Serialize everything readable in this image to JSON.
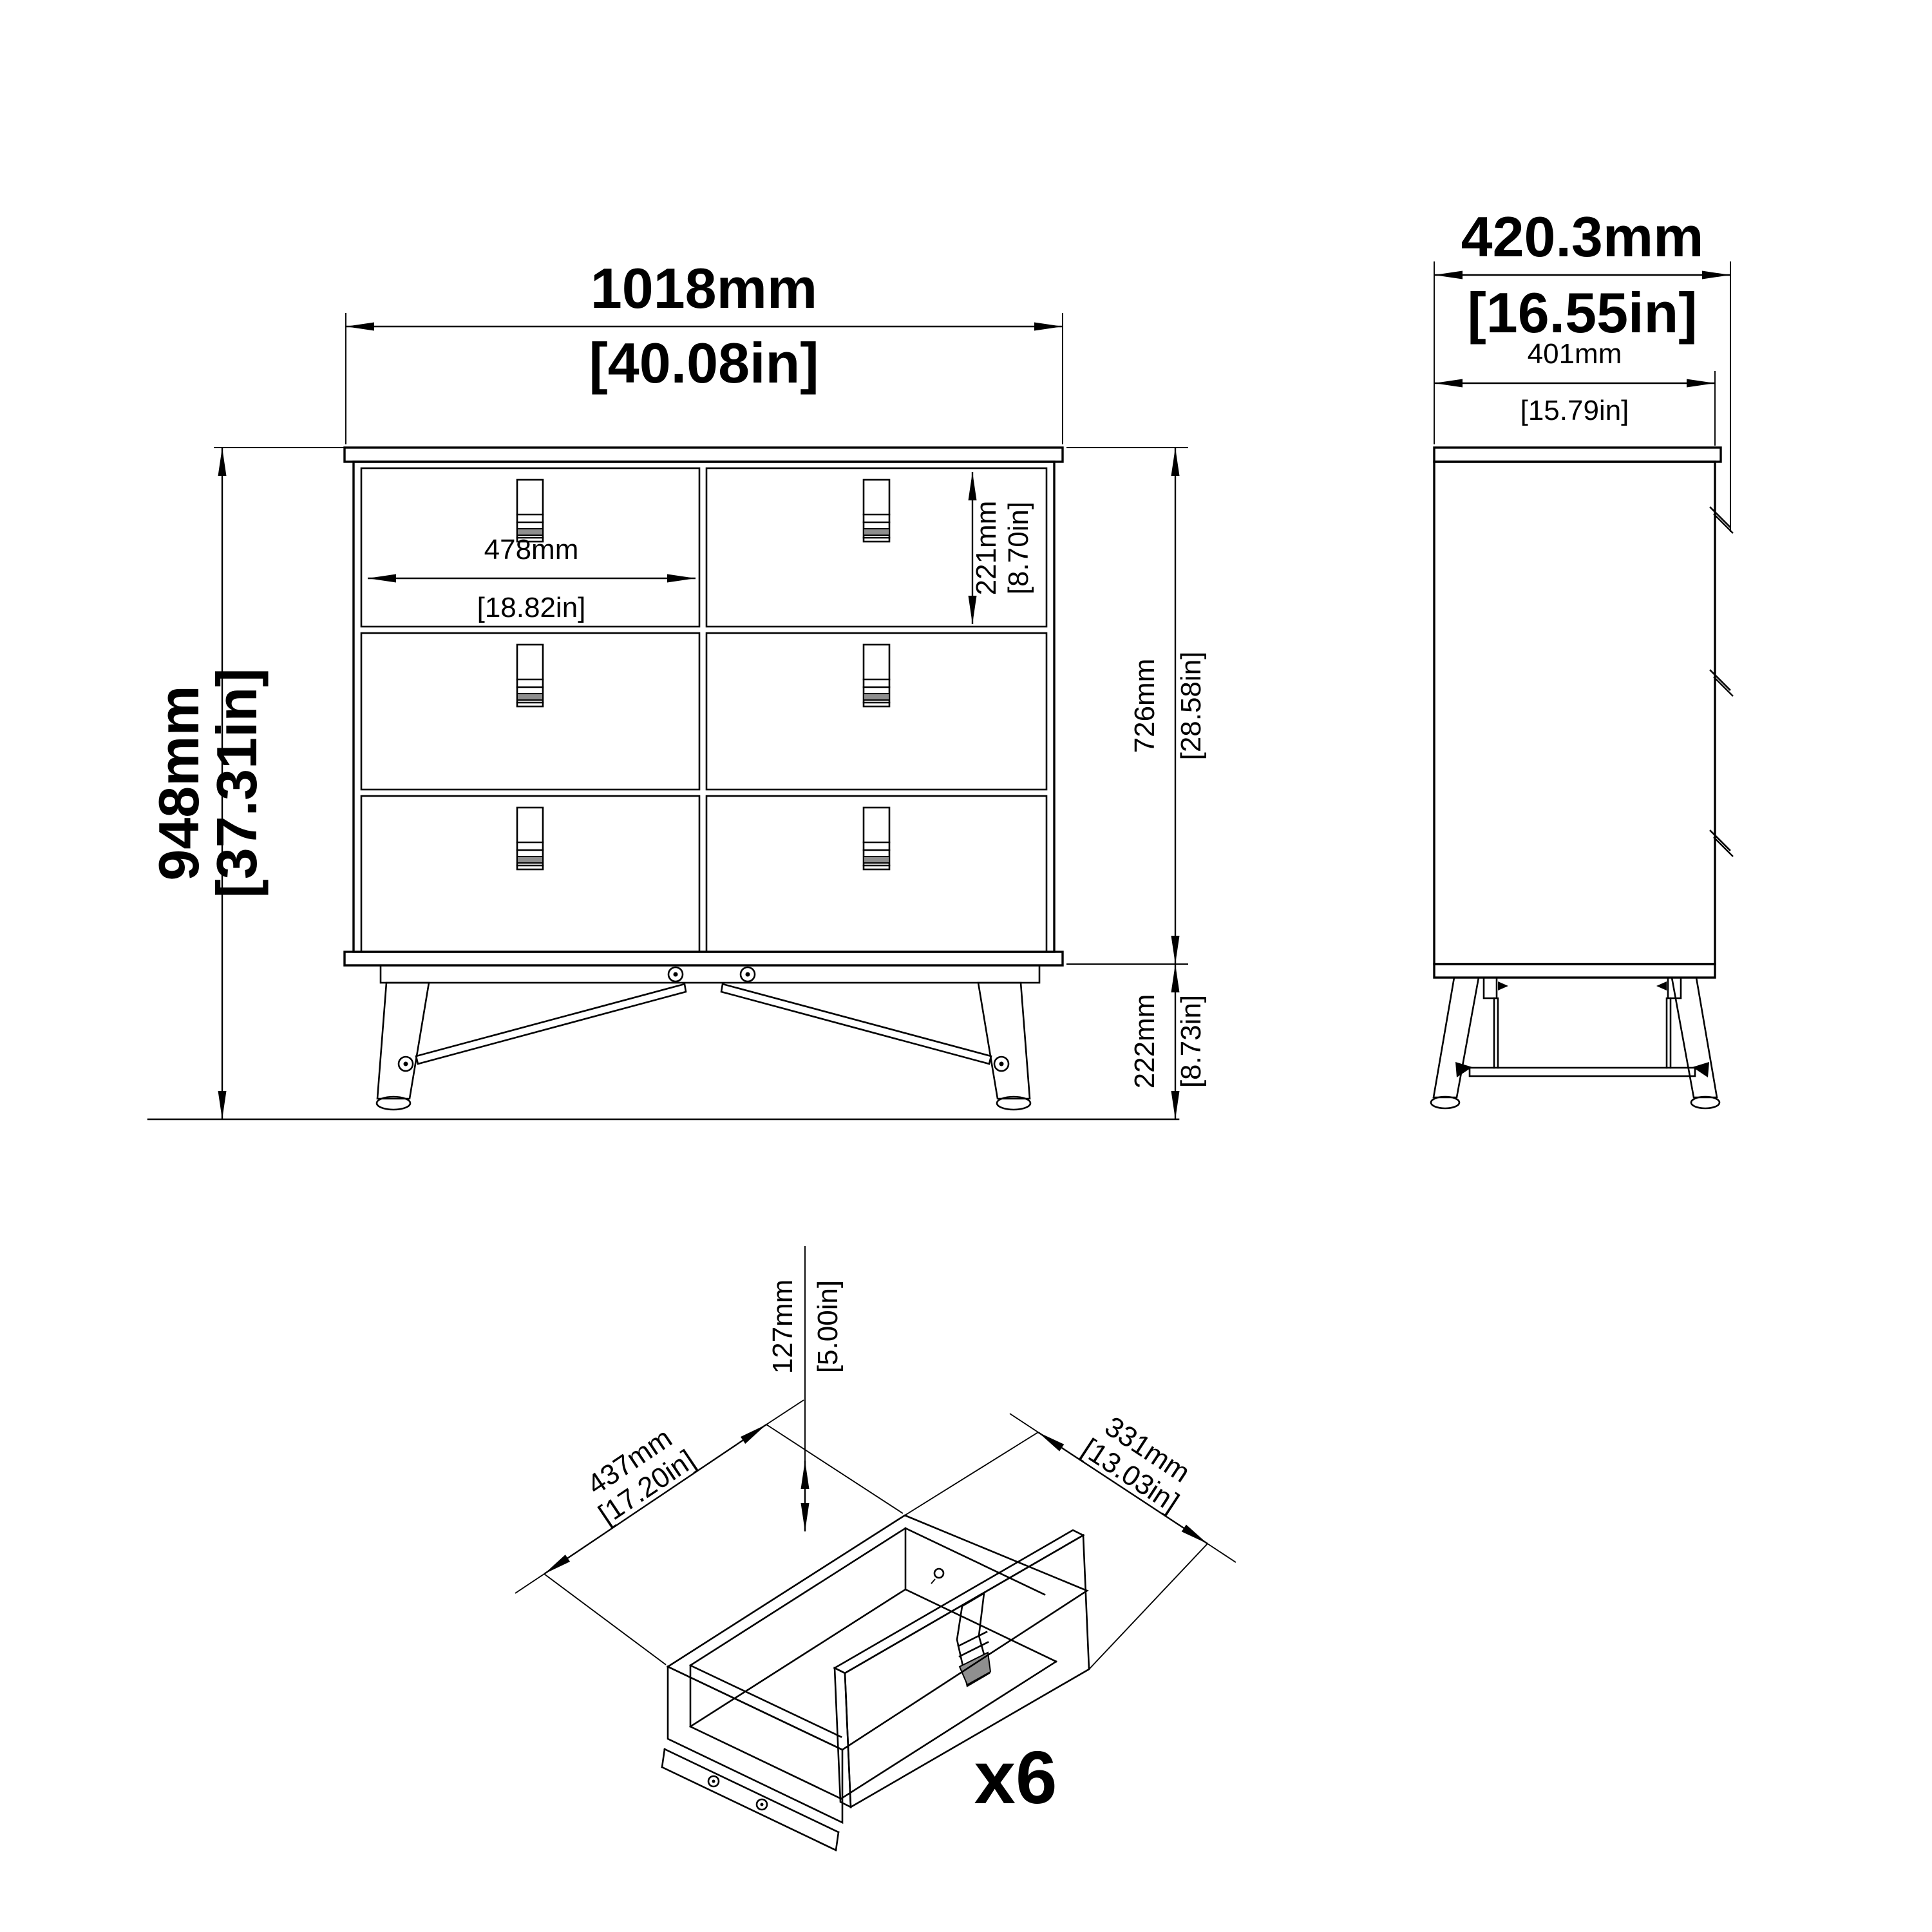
{
  "colors": {
    "line": "#000000",
    "bg": "#ffffff",
    "metal": "#8f8f8f"
  },
  "drawing": {
    "front": {
      "width_mm": "1018mm",
      "width_in": "[40.08in]",
      "height_mm": "948mm",
      "height_in": "[37.31in]",
      "drawer_width_mm": "478mm",
      "drawer_width_in": "[18.82in]",
      "top_drawer_height_mm": "221mm",
      "top_drawer_height_in": "[8.70in]",
      "body_height_mm": "726mm",
      "body_height_in": "[28.58in]",
      "leg_height_mm": "222mm",
      "leg_height_in": "[8.73in]"
    },
    "side": {
      "depth_mm": "420.3mm",
      "depth_in": "[16.55in]",
      "inner_depth_mm": "401mm",
      "inner_depth_in": "[15.79in]"
    },
    "drawer": {
      "height_mm": "127mm",
      "height_in": "[5.00in]",
      "width_mm": "437mm",
      "width_in": "[17.20in]",
      "depth_mm": "331mm",
      "depth_in": "[13.03in]",
      "quantity_label": "x6"
    }
  }
}
